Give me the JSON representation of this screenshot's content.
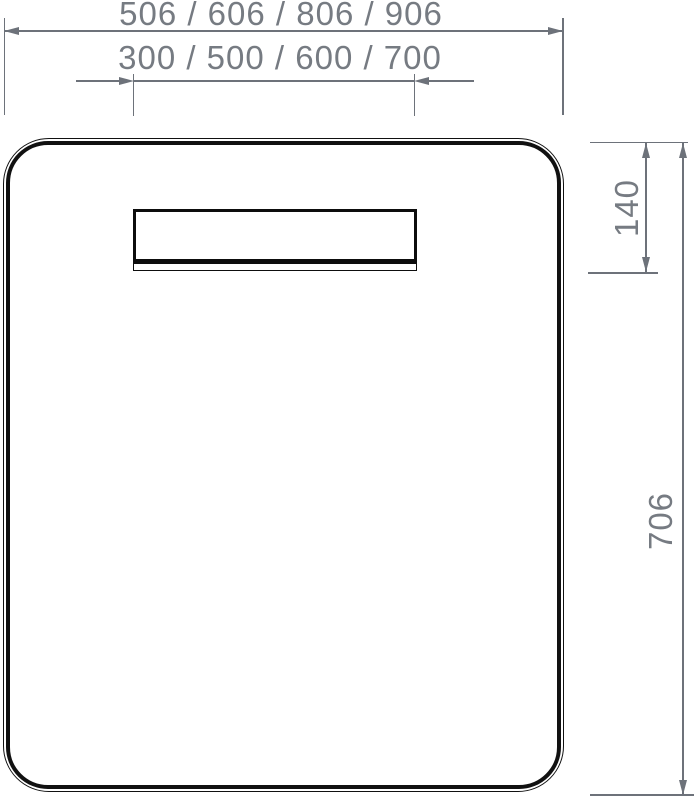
{
  "drawing": {
    "type": "technical-dimension-drawing",
    "subject": "rectangular mirror panel with rounded corners and integrated light strip",
    "dimensions": {
      "outer_width": "506 / 606 / 806 / 906",
      "strip_width": "300 / 500 / 600 / 700",
      "top_to_strip": "140",
      "total_height": "706"
    },
    "colors": {
      "outline_black": "#111111",
      "dimension_gray": "#6d727a",
      "text_gray": "#767b82",
      "background": "#ffffff"
    }
  }
}
